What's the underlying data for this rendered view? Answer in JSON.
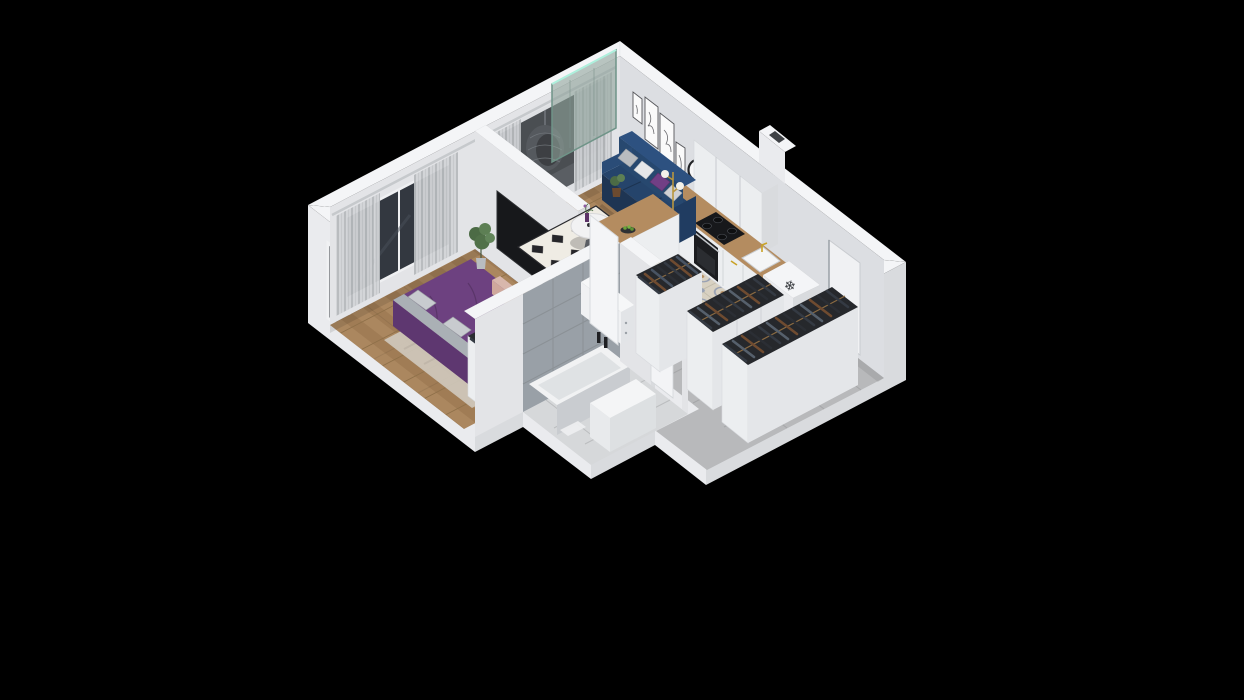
{
  "meta": {
    "title": "3D isometric apartment floor plan render",
    "background": "#000000",
    "width": 1244,
    "height": 700
  },
  "palette": {
    "wallTop": "#f4f5f7",
    "wallLit": "#eaebee",
    "wallShade": "#d9dbde",
    "wallInterior": "#e3e4e7",
    "wallInteriorNE": "#dcdee2",
    "floorWood": "#a8845c",
    "tileKitchen": "#d8d1c2",
    "tileHall": "#b8b9bb",
    "bathFloor": "#d6d8da",
    "bathWallTile": "#99a0a7",
    "sofaNavy": "#25446b",
    "bedPurple": "#6d4180",
    "pillowPurple": "#713f85",
    "benchBlush": "#d8b7ac",
    "rugBedroom": "#cdc5b8",
    "rugLivingBase": "#efece4",
    "rugLivingDiamond": "#26262a",
    "counterWood": "#b48c60",
    "counterDarkWood": "#6e4c31",
    "applianceBlack": "#17181b",
    "brassGold": "#c9a227",
    "clothesDark": "#343a43",
    "glassTeal": "#8fa39b",
    "windowGlassDark": "#333840",
    "curtain": "#d2d4d7",
    "plantGreen": "#55754c",
    "eggChair": "#34383d",
    "clockFace": "#f6f6f7"
  },
  "icons": {
    "snowflake": "❄"
  },
  "rooms": {
    "bedroom": {
      "label": "Bedroom",
      "items": [
        "double-bed",
        "area-rug",
        "foot-bench",
        "open-wardrobe",
        "tv",
        "potted-plant",
        "curtains",
        "window"
      ]
    },
    "living": {
      "label": "Living room",
      "items": [
        "navy-sofa",
        "throw-pillows",
        "diamond-rug",
        "round-coffee-table",
        "floor-lamp",
        "wall-art-frames",
        "wall-clock",
        "white-dresser"
      ]
    },
    "kitchen": {
      "label": "Kitchen",
      "items": [
        "upper-cabinets",
        "wood-counter",
        "cooktop",
        "oven",
        "sink",
        "freezer-box",
        "breakfast-bar",
        "bar-stools",
        "fruit-plate",
        "vent-shaft"
      ]
    },
    "bathroom": {
      "label": "Bathroom",
      "items": [
        "bathtub",
        "candles",
        "vanity",
        "bath-mat",
        "tiled-walls"
      ]
    },
    "hallway": {
      "label": "Hallway",
      "items": [
        "wardrobe-2",
        "wardrobe-3",
        "wardrobe-4",
        "entrance-door",
        "stone-tile-floor"
      ]
    },
    "balcony": {
      "label": "Balcony",
      "items": [
        "hanging-egg-chair",
        "glass-divider"
      ]
    }
  },
  "counts": {
    "wall_art_frames": 5,
    "sofa_pillows": 4,
    "bar_stools": 2,
    "wardrobes": 4,
    "cooktop_burners": 4
  }
}
